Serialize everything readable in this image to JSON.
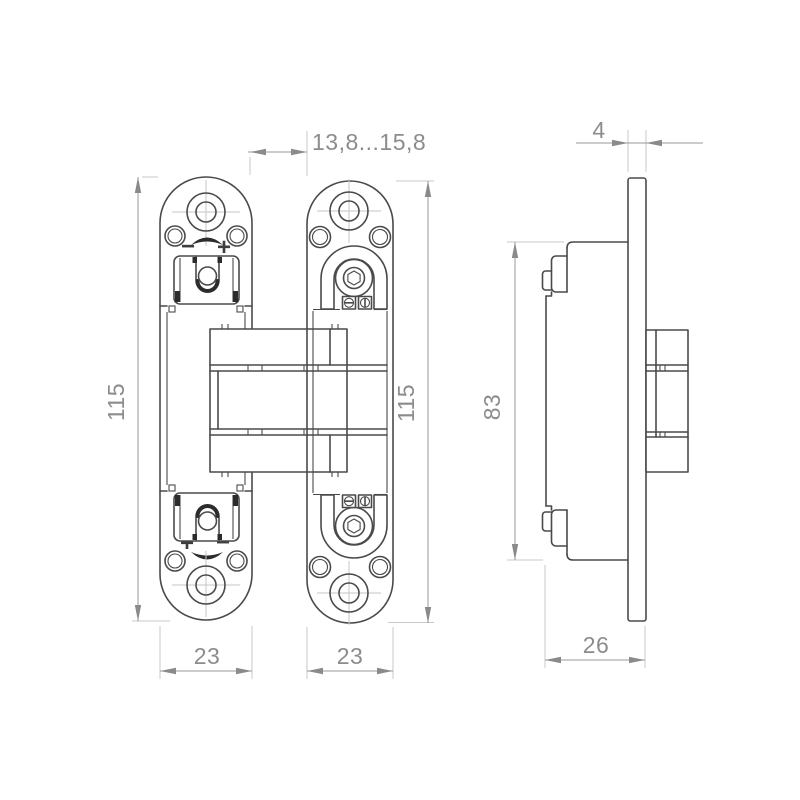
{
  "colors": {
    "background": "#ffffff",
    "part_line": "#4a4a4a",
    "detail_dark": "#2c2c2c",
    "dimension_line": "#9a9a9a",
    "extension_line": "#c9c9c9",
    "dimension_text": "#8c8c8c"
  },
  "views": {
    "front": {
      "gap_label": "13,8...15,8",
      "left_plate": {
        "height_label": "115",
        "width_label": "23",
        "adjust_top": {
          "minus": "−",
          "plus": "+"
        },
        "adjust_bottom": {
          "plus": "+",
          "minus": "−"
        }
      },
      "door_plate": {
        "height_label": "115",
        "width_label": "23"
      }
    },
    "side": {
      "thickness_label": "4",
      "height_label": "83",
      "depth_label": "26"
    }
  }
}
